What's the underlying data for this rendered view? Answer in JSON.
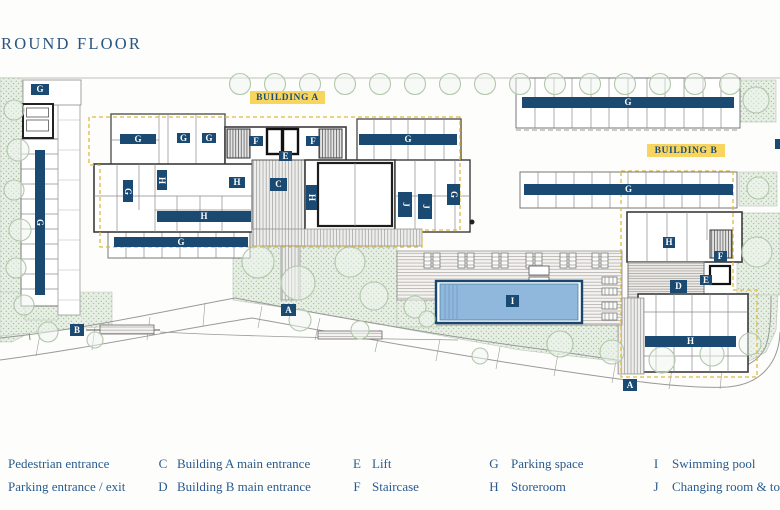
{
  "title": "ROUND FLOOR",
  "plan": {
    "building_a_label": "BUILDING A",
    "building_b_label": "BUILDING B",
    "colors": {
      "marker_navy": "#1a4971",
      "text_navy": "#2a5b8e",
      "label_yellow": "#f8d55e",
      "boundary_dash_yellow": "#e0ba3f",
      "pool_water": "#8fb8dc",
      "landscape_green": "#e7efe5",
      "wall": "#3b3b3b"
    },
    "markers": [
      {
        "text": "G",
        "x": 31,
        "y": 84,
        "w": 18,
        "h": 11
      },
      {
        "text": "G",
        "x": 35,
        "y": 150,
        "w": 10,
        "h": 145,
        "rot": 1
      },
      {
        "text": "G",
        "x": 120,
        "y": 134,
        "w": 36,
        "h": 10
      },
      {
        "text": "G",
        "x": 177,
        "y": 133,
        "w": 13,
        "h": 10
      },
      {
        "text": "G",
        "x": 202,
        "y": 133,
        "w": 14,
        "h": 10
      },
      {
        "text": "F",
        "x": 249,
        "y": 136,
        "w": 14,
        "h": 10
      },
      {
        "text": "F",
        "x": 306,
        "y": 136,
        "w": 14,
        "h": 10
      },
      {
        "text": "E",
        "x": 279,
        "y": 151,
        "w": 13,
        "h": 10
      },
      {
        "text": "C",
        "x": 270,
        "y": 178,
        "w": 17,
        "h": 13
      },
      {
        "text": "G",
        "x": 123,
        "y": 180,
        "w": 10,
        "h": 22,
        "rot": 1
      },
      {
        "text": "H",
        "x": 157,
        "y": 170,
        "w": 10,
        "h": 20,
        "rot": 1
      },
      {
        "text": "H",
        "x": 229,
        "y": 177,
        "w": 16,
        "h": 11
      },
      {
        "text": "H",
        "x": 306,
        "y": 185,
        "w": 11,
        "h": 25,
        "rot": 1
      },
      {
        "text": "H",
        "x": 157,
        "y": 211,
        "w": 94,
        "h": 11
      },
      {
        "text": "G",
        "x": 359,
        "y": 134,
        "w": 98,
        "h": 11
      },
      {
        "text": "J",
        "x": 398,
        "y": 192,
        "w": 14,
        "h": 25,
        "rot": 1
      },
      {
        "text": "J",
        "x": 418,
        "y": 194,
        "w": 14,
        "h": 25,
        "rot": 1
      },
      {
        "text": "G",
        "x": 447,
        "y": 184,
        "w": 13,
        "h": 21,
        "rot": 1
      },
      {
        "text": "G",
        "x": 522,
        "y": 97,
        "w": 212,
        "h": 11
      },
      {
        "text": "G",
        "x": 524,
        "y": 184,
        "w": 209,
        "h": 11
      },
      {
        "text": "G",
        "x": 114,
        "y": 237,
        "w": 134,
        "h": 10
      },
      {
        "text": "H",
        "x": 663,
        "y": 237,
        "w": 12,
        "h": 11
      },
      {
        "text": "F",
        "x": 714,
        "y": 251,
        "w": 13,
        "h": 11
      },
      {
        "text": "E",
        "x": 700,
        "y": 275,
        "w": 12,
        "h": 10
      },
      {
        "text": "D",
        "x": 670,
        "y": 280,
        "w": 17,
        "h": 13
      },
      {
        "text": "H",
        "x": 645,
        "y": 336,
        "w": 91,
        "h": 11
      },
      {
        "text": "A",
        "x": 623,
        "y": 379,
        "w": 14,
        "h": 12
      },
      {
        "text": "A",
        "x": 281,
        "y": 304,
        "w": 15,
        "h": 12
      },
      {
        "text": "B",
        "x": 70,
        "y": 324,
        "w": 14,
        "h": 12
      },
      {
        "text": "I",
        "x": 506,
        "y": 295,
        "w": 13,
        "h": 12
      }
    ]
  },
  "legend": {
    "items": [
      {
        "key": "",
        "label": "Pedestrian entrance"
      },
      {
        "key": "",
        "label": "Parking entrance / exit"
      },
      {
        "key": "C",
        "label": "Building A main entrance"
      },
      {
        "key": "D",
        "label": "Building B main entrance"
      },
      {
        "key": "E",
        "label": "Lift"
      },
      {
        "key": "F",
        "label": "Staircase"
      },
      {
        "key": "G",
        "label": "Parking space"
      },
      {
        "key": "H",
        "label": "Storeroom"
      },
      {
        "key": "I",
        "label": "Swimming pool"
      },
      {
        "key": "J",
        "label": "Changing room & toilets"
      }
    ]
  }
}
